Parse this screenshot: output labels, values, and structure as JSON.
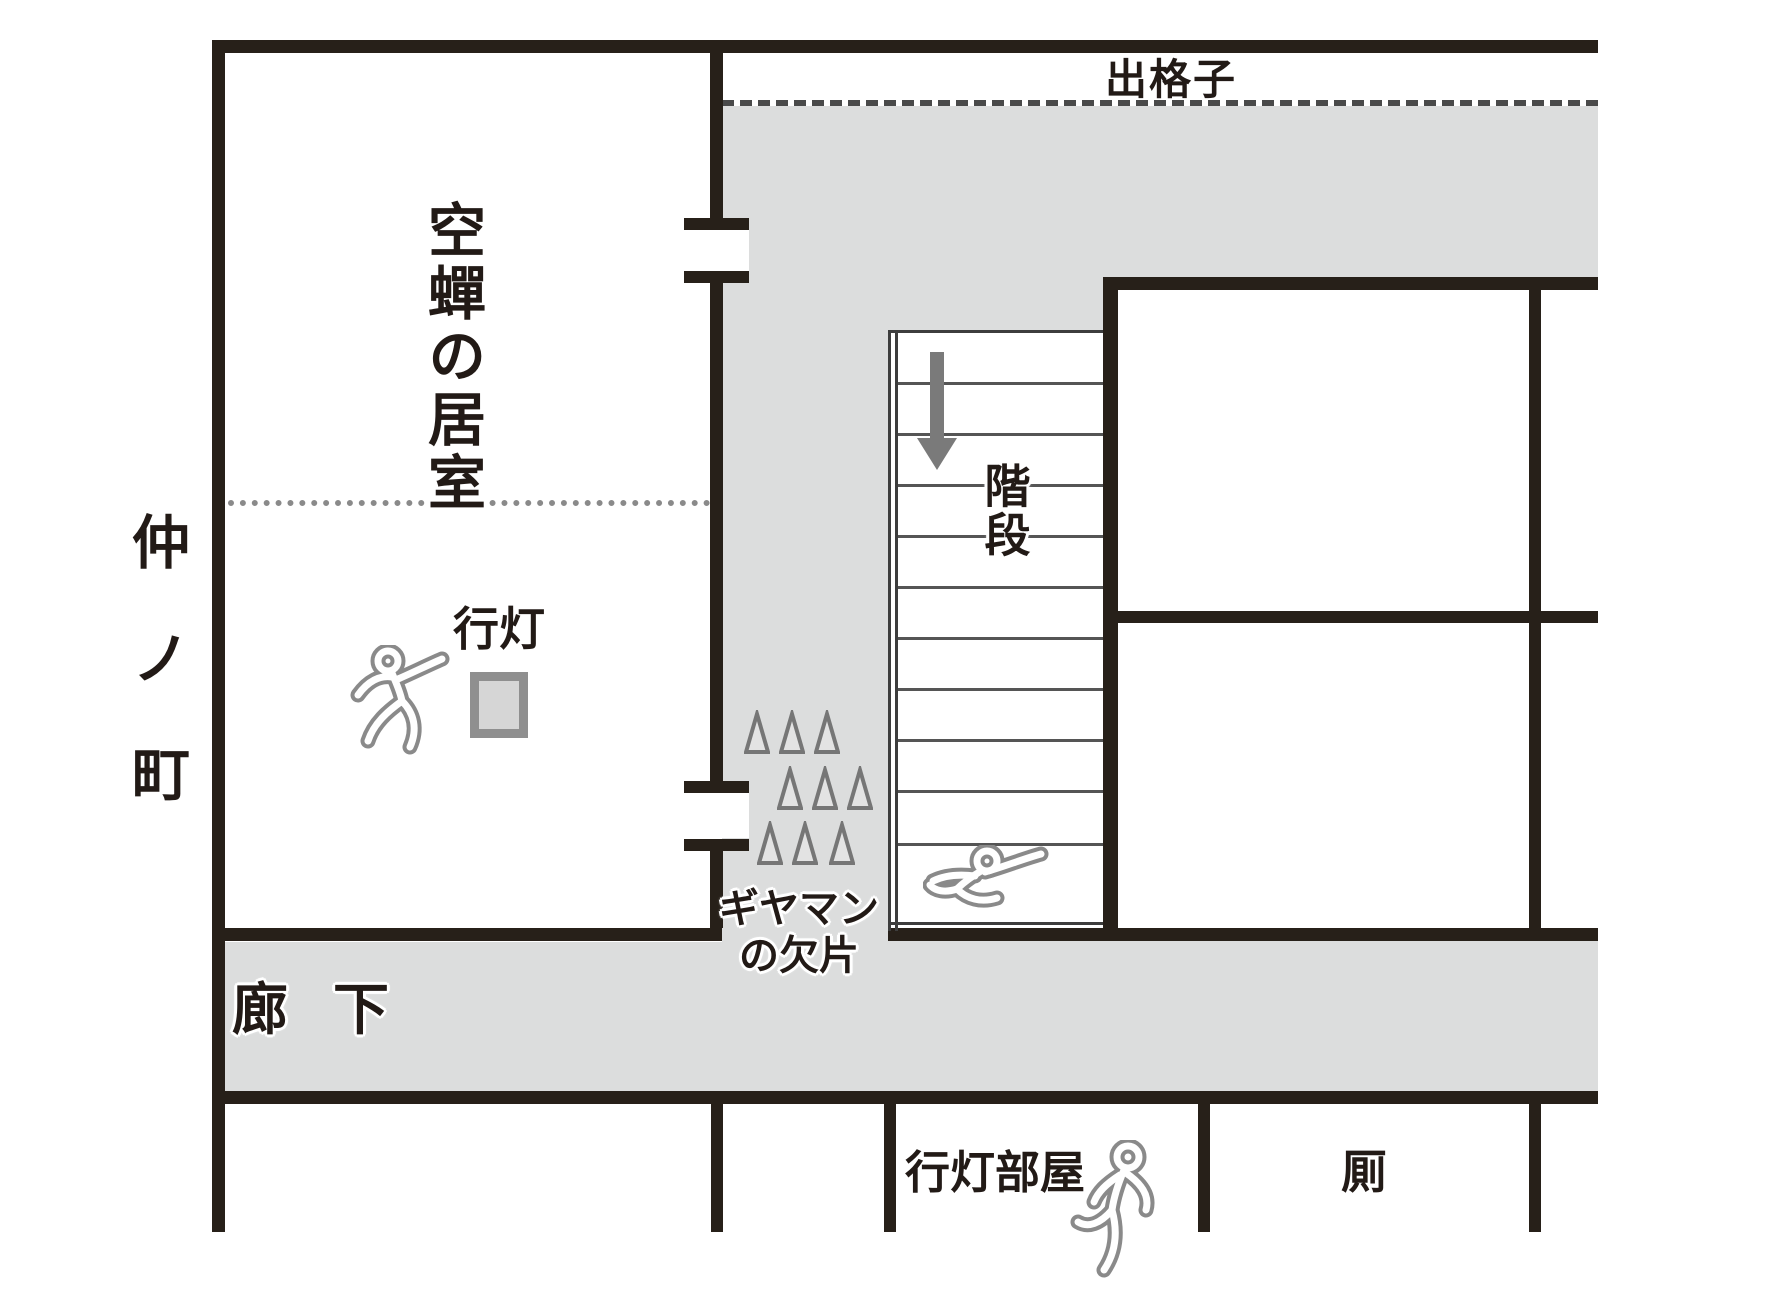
{
  "diagram": {
    "type": "japanese-floor-plan",
    "labels": {
      "lattice_window": "出格子",
      "utsusemi_room": "空蟬の居室",
      "street": "仲ノ町",
      "lantern": "行灯",
      "stairs": "階段",
      "glass_line1": "ギヤマン",
      "glass_line2": "の欠片",
      "corridor": "廊下",
      "lantern_room": "行灯部屋",
      "privy": "厠"
    },
    "icons": {
      "body_outline_room": "chalk-body-outline",
      "body_outline_stairs": "chalk-body-outline",
      "body_outline_lantern_room": "chalk-body-outline",
      "down_arrow": "down-arrow",
      "glass_shards": "nine-triangle-shards"
    },
    "colors": {
      "wall": "#272019",
      "floor-gray": "#dcdddd",
      "chalk": "#8a8a8a",
      "arrow": "#7a7a7a",
      "step-line": "#555555",
      "shard-stroke": "#767676",
      "shard-fill": "#e3e3e3",
      "lantern-border": "#8f8f8f",
      "lantern-fill": "#d6d6d6",
      "text": "#221a16"
    }
  }
}
